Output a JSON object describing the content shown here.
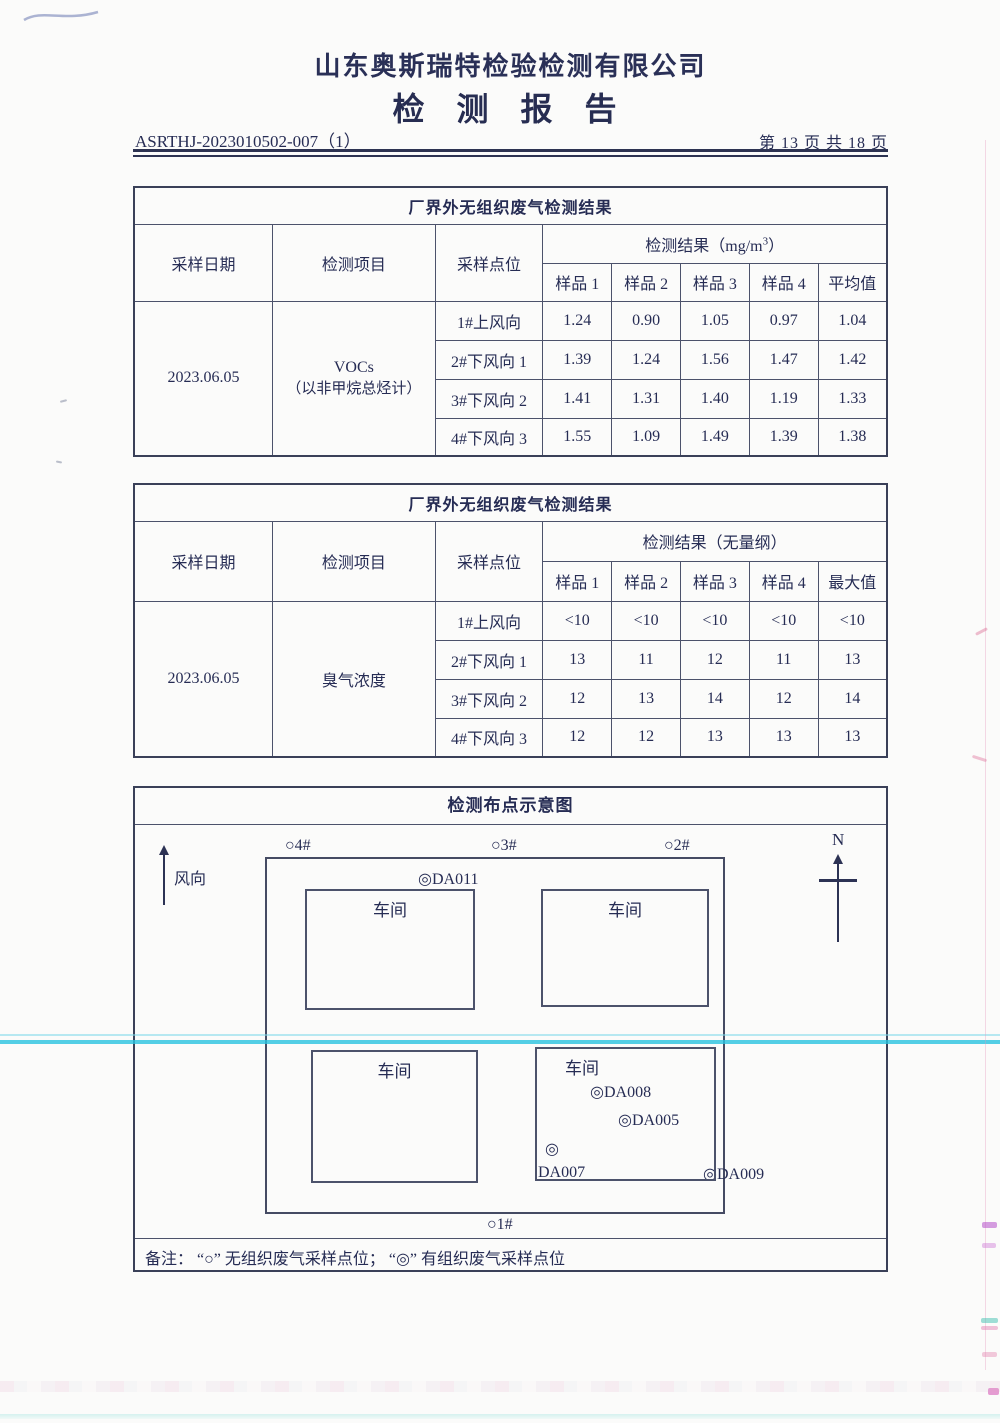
{
  "page": {
    "company": "山东奥斯瑞特检验检测有限公司",
    "title": "检 测 报 告",
    "report_no": "ASRTHJ-2023010502-007（1）",
    "page_info": "第 13 页 共 18 页"
  },
  "table1": {
    "title": "厂界外无组织废气检测结果",
    "col_date": "采样日期",
    "col_item": "检测项目",
    "col_point": "采样点位",
    "unit_prefix": "检测结果（mg/m",
    "unit_sup": "3",
    "unit_suffix": "）",
    "sub_cols": [
      "样品 1",
      "样品 2",
      "样品 3",
      "样品 4",
      "平均值"
    ],
    "date": "2023.06.05",
    "item_line1": "VOCs",
    "item_line2": "（以非甲烷总烃计）",
    "rows": [
      {
        "point": "1#上风向",
        "values": [
          "1.24",
          "0.90",
          "1.05",
          "0.97",
          "1.04"
        ]
      },
      {
        "point": "2#下风向 1",
        "values": [
          "1.39",
          "1.24",
          "1.56",
          "1.47",
          "1.42"
        ]
      },
      {
        "point": "3#下风向 2",
        "values": [
          "1.41",
          "1.31",
          "1.40",
          "1.19",
          "1.33"
        ]
      },
      {
        "point": "4#下风向 3",
        "values": [
          "1.55",
          "1.09",
          "1.49",
          "1.39",
          "1.38"
        ]
      }
    ]
  },
  "table2": {
    "title": "厂界外无组织废气检测结果",
    "col_date": "采样日期",
    "col_item": "检测项目",
    "col_point": "采样点位",
    "unit": "检测结果（无量纲）",
    "sub_cols": [
      "样品 1",
      "样品 2",
      "样品 3",
      "样品 4",
      "最大值"
    ],
    "date": "2023.06.05",
    "item": "臭气浓度",
    "rows": [
      {
        "point": "1#上风向",
        "values": [
          "<10",
          "<10",
          "<10",
          "<10",
          "<10"
        ]
      },
      {
        "point": "2#下风向 1",
        "values": [
          "13",
          "11",
          "12",
          "11",
          "13"
        ]
      },
      {
        "point": "3#下风向 2",
        "values": [
          "12",
          "13",
          "14",
          "12",
          "14"
        ]
      },
      {
        "point": "4#下风向 3",
        "values": [
          "12",
          "12",
          "13",
          "13",
          "13"
        ]
      }
    ]
  },
  "diagram": {
    "title": "检测布点示意图",
    "wind_label": "风向",
    "north_label": "N",
    "workshop_label": "车间",
    "marker_p4": "○4#",
    "marker_p3": "○3#",
    "marker_p2": "○2#",
    "marker_p1": "○1#",
    "marker_da011": "◎DA011",
    "marker_da008": "◎DA008",
    "marker_da005": "◎DA005",
    "marker_da007_symbol": "◎",
    "marker_da007_label": "DA007",
    "marker_da009": "◎DA009",
    "note": "备注： “○” 无组织废气采样点位； “◎” 有组织废气采样点位"
  },
  "colors": {
    "ink": "#262c54",
    "table_border": "#4c526b",
    "cyan_artifact": "#29c3e0",
    "pink_artifact": "#e496b9"
  }
}
